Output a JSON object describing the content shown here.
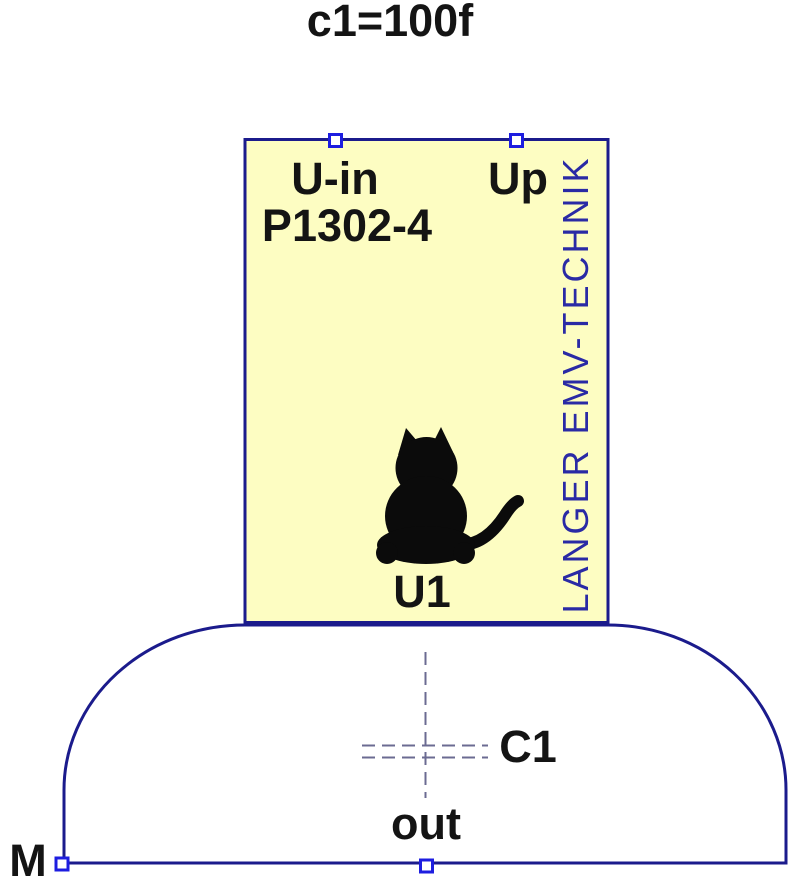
{
  "annotation": {
    "value_text": "c1=100f"
  },
  "component": {
    "input_pin_label": "U-in",
    "output_pin_label": "Up",
    "part_number": "P1302-4",
    "designator": "U1",
    "brand_text": "LANGER EMV-TECHNIK"
  },
  "capacitor": {
    "designator": "C1",
    "output_net_label": "out",
    "ground_net_label": "M"
  },
  "icons": {
    "logo": "cat-icon"
  },
  "colors": {
    "background": "#ffffff",
    "body_fill": "#fdfdc2",
    "outline_navy": "#1b1b8c",
    "pin_blue": "#1d1de0",
    "brand_blue": "#2a2aa5",
    "dashed_gray": "#6b6b92",
    "label_black": "#141414",
    "cat_black": "#0b0b0b"
  }
}
